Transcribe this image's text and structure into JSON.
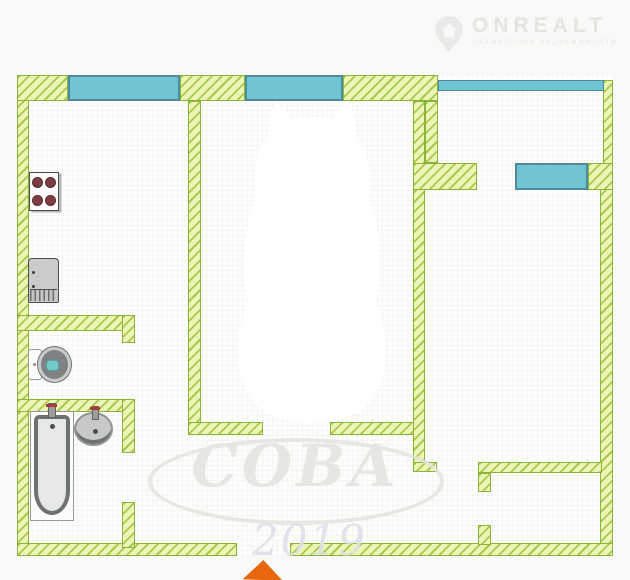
{
  "watermark": {
    "brand": "ONREALT",
    "brand_subtitle": "ОБЪЯВЛЕНИЯ НЕДВИЖИМОСТИ",
    "emblem_text": "СОВА",
    "year": "2019"
  },
  "plan": {
    "type": "apartment-floor-plan",
    "colors": {
      "wall_fill": "#ecf4b6",
      "wall_hatch": "#a6c94e",
      "wall_border": "#8cb43a",
      "window_fill": "#70c4d4",
      "window_border": "#4e8b9c",
      "entry_arrow": "#e8660e",
      "background": "#f9f9f7"
    },
    "walls": [
      {
        "name": "left-wall",
        "type": "wall",
        "x": 17,
        "y": 75,
        "w": 12,
        "h": 481
      },
      {
        "name": "top-wall-a",
        "type": "wall",
        "x": 17,
        "y": 75,
        "w": 51,
        "h": 26
      },
      {
        "name": "kitchen-window",
        "type": "window",
        "x": 68,
        "y": 75,
        "w": 112,
        "h": 26
      },
      {
        "name": "top-wall-b",
        "type": "wall",
        "x": 180,
        "y": 75,
        "w": 65,
        "h": 26
      },
      {
        "name": "room1-window",
        "type": "window",
        "x": 245,
        "y": 75,
        "w": 98,
        "h": 26
      },
      {
        "name": "top-wall-c",
        "type": "wall",
        "x": 343,
        "y": 75,
        "w": 95,
        "h": 26
      },
      {
        "name": "balcony-glazing",
        "type": "glazing",
        "x": 438,
        "y": 80,
        "w": 166,
        "h": 11
      },
      {
        "name": "balcony-right-wall",
        "type": "wall",
        "x": 603,
        "y": 80,
        "w": 10,
        "h": 84
      },
      {
        "name": "right-wall",
        "type": "wall",
        "x": 600,
        "y": 163,
        "w": 13,
        "h": 393
      },
      {
        "name": "bottom-wall-left",
        "type": "wall",
        "x": 17,
        "y": 543,
        "w": 220,
        "h": 13
      },
      {
        "name": "bottom-wall-right",
        "type": "wall",
        "x": 290,
        "y": 543,
        "w": 323,
        "h": 13
      },
      {
        "name": "kitchen-room-divider",
        "type": "wall",
        "x": 188,
        "y": 101,
        "w": 13,
        "h": 327
      },
      {
        "name": "kitchen-divider-foot",
        "type": "wall",
        "x": 188,
        "y": 422,
        "w": 75,
        "h": 13
      },
      {
        "name": "room1-bottom-wall",
        "type": "wall",
        "x": 330,
        "y": 422,
        "w": 95,
        "h": 13
      },
      {
        "name": "room-divider",
        "type": "wall",
        "x": 413,
        "y": 101,
        "w": 12,
        "h": 371
      },
      {
        "name": "room-divider-thick",
        "type": "wall",
        "x": 425,
        "y": 101,
        "w": 13,
        "h": 62
      },
      {
        "name": "balcony-wall-left",
        "type": "wall",
        "x": 413,
        "y": 163,
        "w": 64,
        "h": 27
      },
      {
        "name": "balcony-window",
        "type": "window",
        "x": 515,
        "y": 163,
        "w": 73,
        "h": 27
      },
      {
        "name": "balcony-wall-right",
        "type": "wall",
        "x": 588,
        "y": 163,
        "w": 25,
        "h": 27
      },
      {
        "name": "room-divider-foot",
        "type": "wall",
        "x": 413,
        "y": 462,
        "w": 24,
        "h": 10
      },
      {
        "name": "kitchen-bottom-wall",
        "type": "wall",
        "x": 17,
        "y": 315,
        "w": 116,
        "h": 16
      },
      {
        "name": "kitchen-bottom-stub",
        "type": "wall",
        "x": 122,
        "y": 315,
        "w": 13,
        "h": 28
      },
      {
        "name": "wc-bottom-wall",
        "type": "wall",
        "x": 17,
        "y": 399,
        "w": 106,
        "h": 13
      },
      {
        "name": "wc-bottom-stub",
        "type": "wall",
        "x": 122,
        "y": 399,
        "w": 13,
        "h": 54
      },
      {
        "name": "bath-door-stub",
        "type": "wall",
        "x": 122,
        "y": 502,
        "w": 13,
        "h": 46
      },
      {
        "name": "closet-wall",
        "type": "wall",
        "x": 478,
        "y": 462,
        "w": 124,
        "h": 11
      },
      {
        "name": "closet-stub-top",
        "type": "wall",
        "x": 478,
        "y": 473,
        "w": 13,
        "h": 19
      },
      {
        "name": "closet-stub-bottom",
        "type": "wall",
        "x": 478,
        "y": 525,
        "w": 13,
        "h": 20
      }
    ],
    "fixtures": [
      "stove",
      "refrigerator",
      "toilet",
      "bathtub",
      "sink"
    ],
    "entrance": {
      "position": "bottom-center",
      "marker": "orange-arrow-up"
    }
  }
}
